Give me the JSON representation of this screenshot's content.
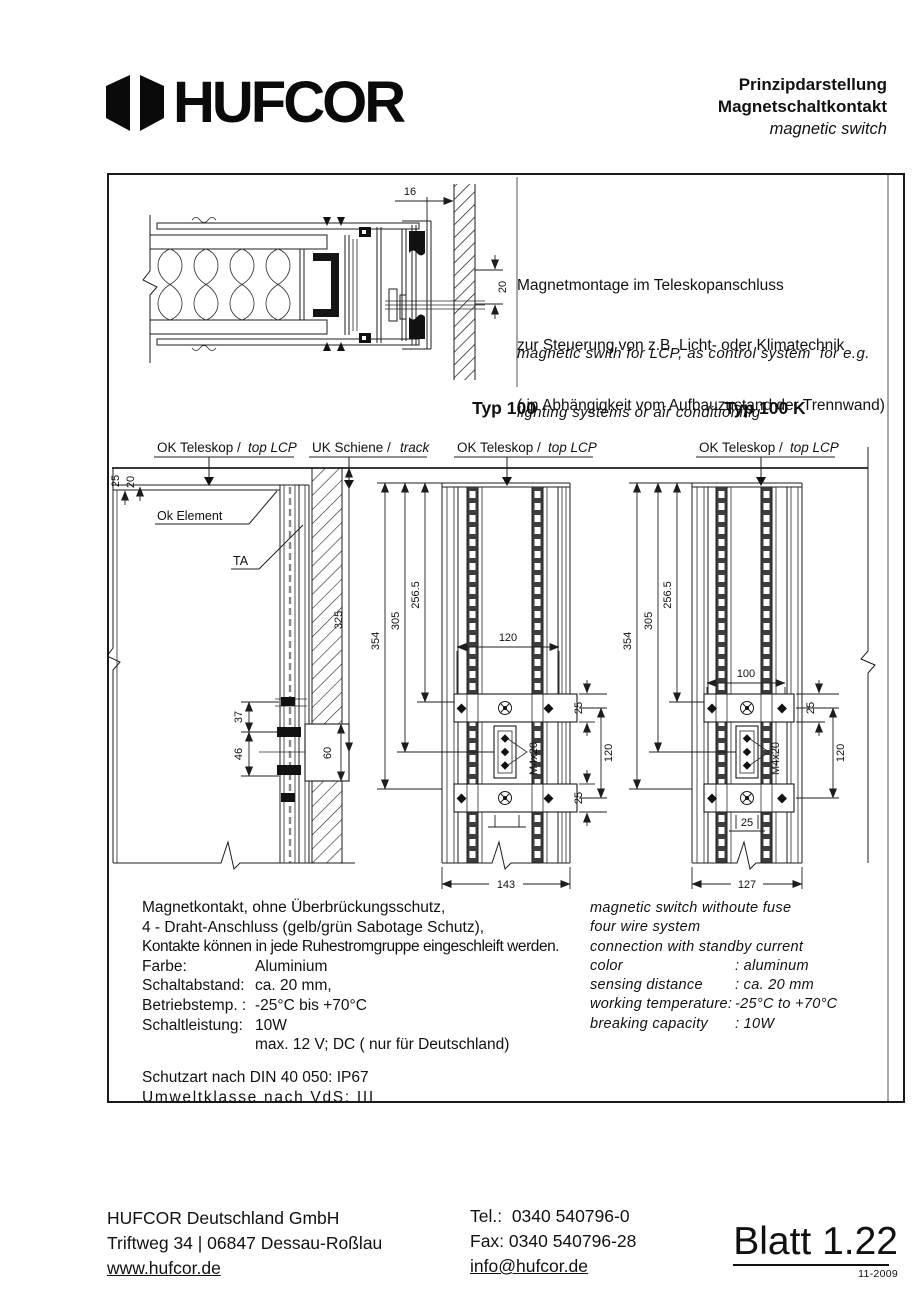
{
  "header": {
    "logo_text": "HUFCOR",
    "title_de_1": "Prinzipdarstellung",
    "title_de_2": "Magnetschaltkontakt",
    "title_en": "magnetic switch"
  },
  "intro": {
    "de1": "Magnetmontage im Teleskopanschluss",
    "de2": "zur Steuerung von z.B. Licht- oder Klimatechnik",
    "de3": "( in Abhängigkeit vom Aufbauzustand der Trennwand)",
    "en1": "magnetic swith for LCP, as control system  for e.g.",
    "en2": "lighting systems or air conditioning"
  },
  "types": {
    "t100": "Typ 100",
    "t100k": "Typ 100 K"
  },
  "callouts": {
    "ok_teleskop": "OK Teleskop /",
    "top_lcp": "top LCP",
    "uk_schiene": "UK Schiene /",
    "track": "track",
    "ok_element": "Ok Element",
    "ta": "TA",
    "m4x20": "M4x20"
  },
  "dims": {
    "d16": "16",
    "d20": "20",
    "d25": "25",
    "d325": "325",
    "d354": "354",
    "d305": "305",
    "d2565": "256.5",
    "d37": "37",
    "d46": "46",
    "d60": "60",
    "d120": "120",
    "d143": "143",
    "d100": "100",
    "d127": "127"
  },
  "specs_de": {
    "line1": "Magnetkontakt, ohne Überbrückungsschutz,",
    "line2": "4 - Draht-Anschluss (gelb/grün Sabotage Schutz),",
    "line3": "Kontakte können in jede Ruhestromgruppe eingeschleift werden.",
    "rows": [
      {
        "label": "Farbe:",
        "value": "Aluminium"
      },
      {
        "label": "Schaltabstand:",
        "value": "ca. 20 mm,"
      },
      {
        "label": "Betriebstemp. :",
        "value": "-25°C bis +70°C"
      },
      {
        "label": "Schaltleistung:",
        "value": "10W"
      },
      {
        "label": "",
        "value": "max. 12 V; DC ( nur für Deutschland)"
      }
    ],
    "schutzart": "Schutzart nach DIN 40 050: IP67",
    "umwelt": "Umweltklasse nach VdS: III"
  },
  "specs_en": {
    "line1": "magnetic switch withoute fuse",
    "line2": "four wire system",
    "line3": "connection with standby current",
    "rows": [
      {
        "label": "color",
        "value": ": aluminum"
      },
      {
        "label": "sensing distance",
        "value": ": ca. 20 mm"
      },
      {
        "label": "working temperature:",
        "value": "-25°C to +70°C"
      },
      {
        "label": "breaking capacity",
        "value": ": 10W"
      }
    ]
  },
  "footer": {
    "company": "HUFCOR Deutschland GmbH",
    "address": "Triftweg 34 | 06847 Dessau-Roßlau",
    "website": "www.hufcor.de",
    "tel": "Tel.:  0340 540796-0",
    "fax": "Fax: 0340 540796-28",
    "email": "info@hufcor.de",
    "sheet": "Blatt 1.22",
    "date": "11-2009"
  }
}
